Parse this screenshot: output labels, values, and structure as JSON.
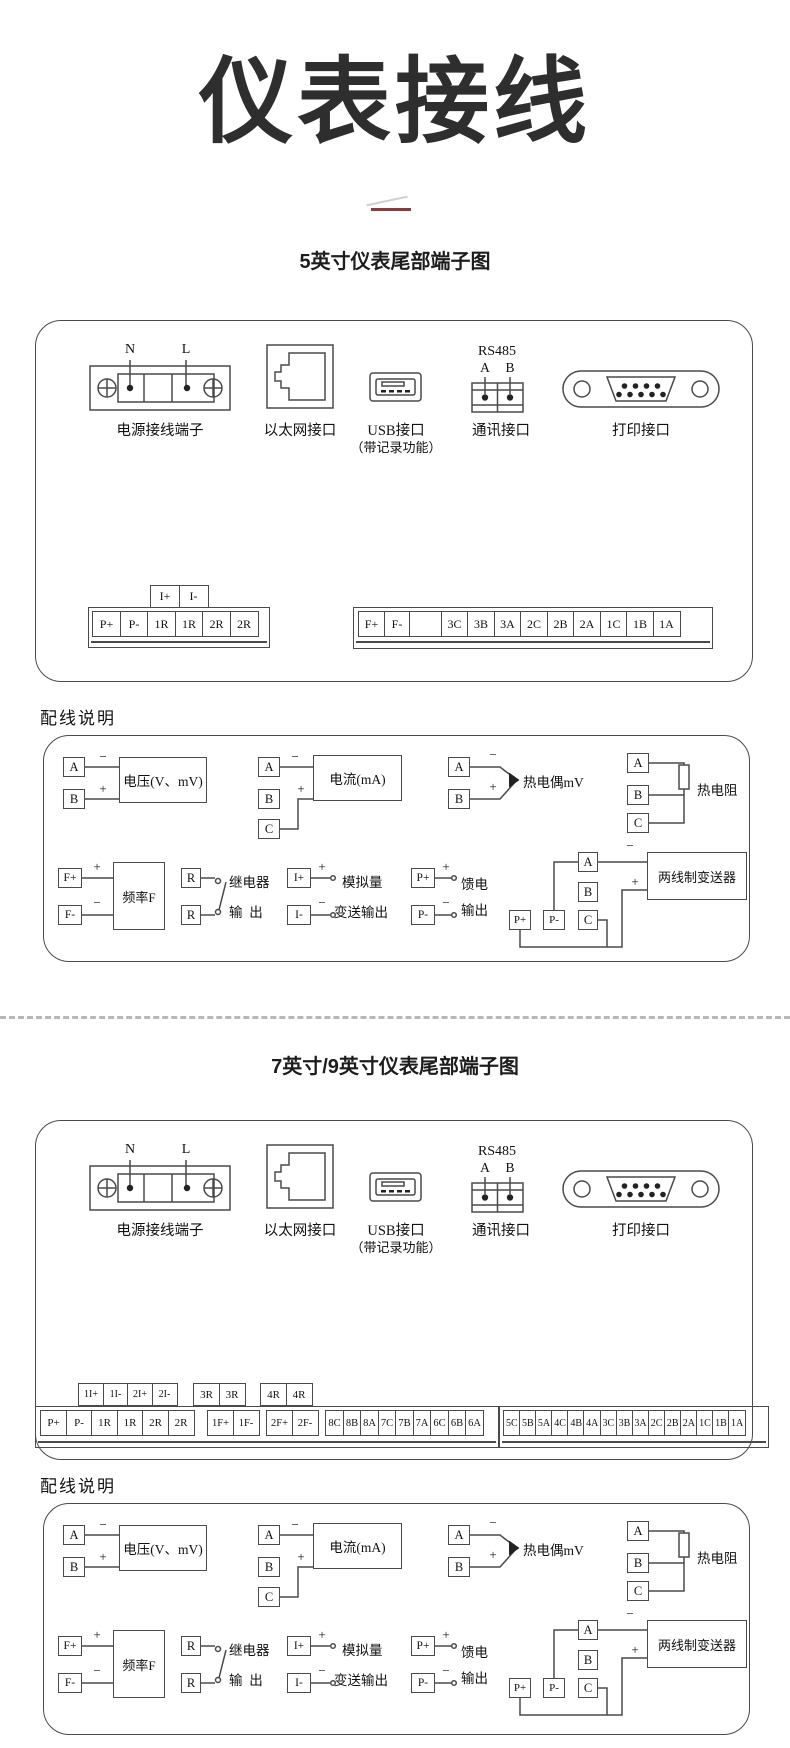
{
  "page": {
    "main_title": "仪表接线",
    "section5_title": "5英寸仪表尾部端子图",
    "section79_title": "7英寸/9英寸仪表尾部端子图",
    "wiring_note_label": "配线说明",
    "accent_color": "#8a3b3b",
    "line_color": "#4a4a4a"
  },
  "ports": {
    "power": {
      "label": "电源接线端子",
      "n": "N",
      "l": "L"
    },
    "ethernet": {
      "label": "以太网接口"
    },
    "usb": {
      "label": "USB接口",
      "sublabel": "（带记录功能）"
    },
    "comm": {
      "label": "通讯接口",
      "rs485": "RS485",
      "a": "A",
      "b": "B"
    },
    "printer": {
      "label": "打印接口"
    }
  },
  "signs": {
    "plus": "+",
    "minus": "−"
  },
  "wiring": {
    "voltage": {
      "t1": "A",
      "t2": "B",
      "label": "电压(V、mV)"
    },
    "current": {
      "t1": "A",
      "t2": "B",
      "t3": "C",
      "label": "电流(mA)"
    },
    "thermocouple": {
      "t1": "A",
      "t2": "B",
      "label": "热电偶mV"
    },
    "rtd": {
      "t1": "A",
      "t2": "B",
      "t3": "C",
      "label": "热电阻"
    },
    "frequency": {
      "t1": "F+",
      "t2": "F-",
      "label": "频率F"
    },
    "relay": {
      "t1": "R",
      "t2": "R",
      "label1": "继电器",
      "label2": "输  出"
    },
    "analog": {
      "t1": "I+",
      "t2": "I-",
      "label1": "模拟量",
      "label2": "变送输出"
    },
    "feed": {
      "t1": "P+",
      "t2": "P-",
      "label1": "馈电",
      "label2": "输出"
    },
    "transmitter": {
      "a": "A",
      "b": "B",
      "c": "C",
      "p1": "P+",
      "p2": "P-",
      "label": "两线制变送器"
    }
  },
  "strips5": {
    "top": [
      "I+",
      "I-"
    ],
    "left": [
      "P+",
      "P-",
      "1R",
      "1R",
      "2R",
      "2R"
    ],
    "right": [
      "F+",
      "F-",
      "",
      "3C",
      "3B",
      "3A",
      "2C",
      "2B",
      "2A",
      "1C",
      "1B",
      "1A"
    ]
  },
  "strips79": {
    "top1": [
      "1I+",
      "1I-",
      "2I+",
      "2I-"
    ],
    "top2": [
      "3R",
      "3R"
    ],
    "top3": [
      "4R",
      "4R"
    ],
    "g1": [
      "P+",
      "P-",
      "1R",
      "1R",
      "2R",
      "2R"
    ],
    "g2": [
      "1F+",
      "1F-"
    ],
    "g3": [
      "2F+",
      "2F-"
    ],
    "g4": [
      "8C",
      "8B",
      "8A",
      "7C",
      "7B",
      "7A",
      "6C",
      "6B",
      "6A"
    ],
    "g5": [
      "5C",
      "5B",
      "5A",
      "4C",
      "4B",
      "4A",
      "3C",
      "3B",
      "3A",
      "2C",
      "2B",
      "2A",
      "1C",
      "1B",
      "1A"
    ]
  }
}
